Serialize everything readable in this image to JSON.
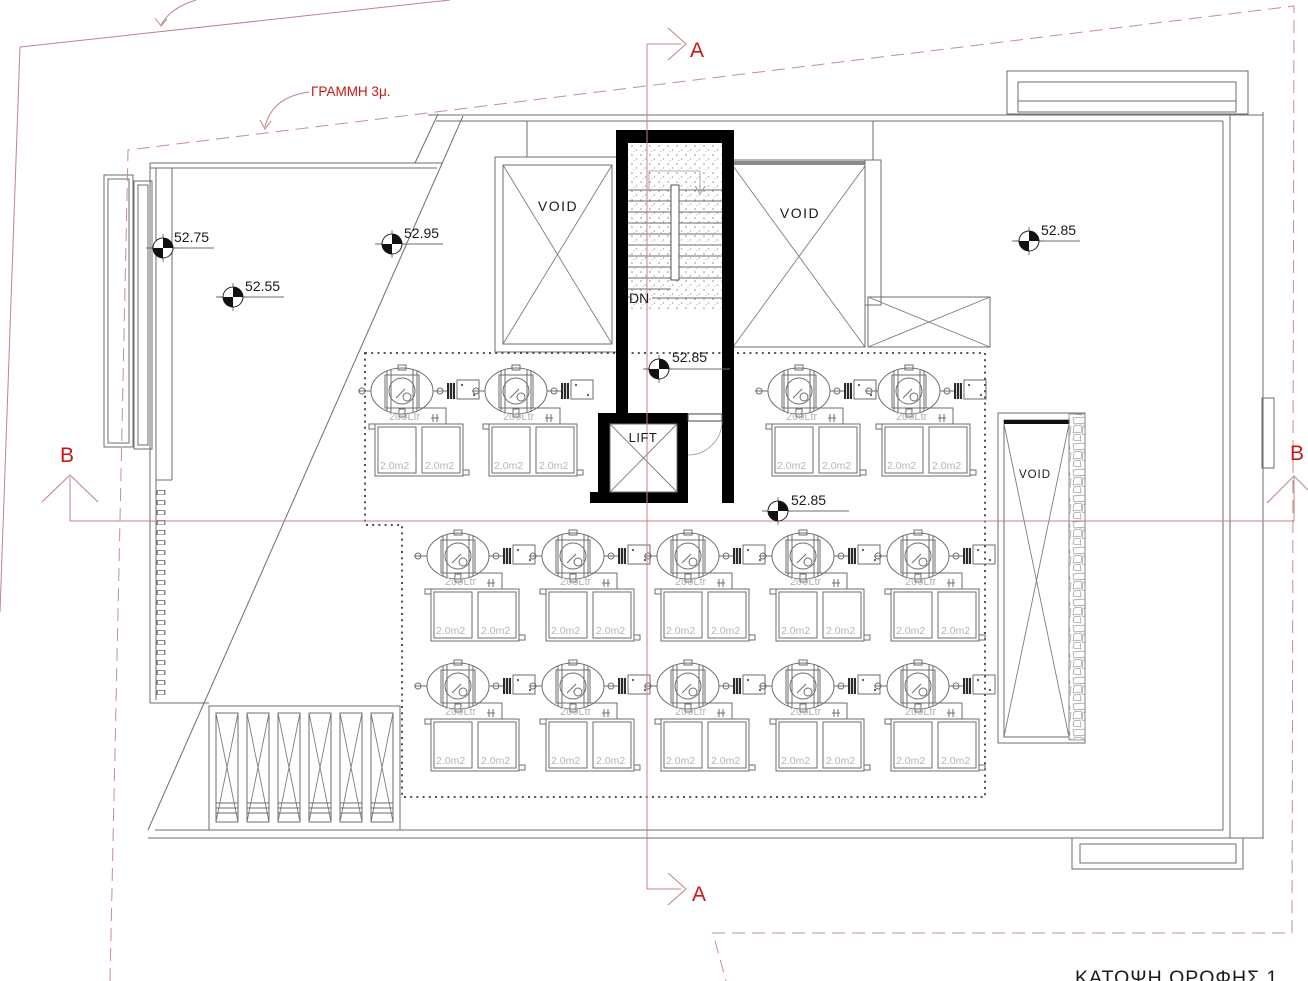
{
  "title": "ΚΑΤΟΨΗ ΟΡΟΦΗΣ 1",
  "annotations": {
    "setback_label": "ΓΡΑΜΜΗ 3μ.",
    "section_a": "A",
    "section_b": "B"
  },
  "labels": {
    "void_label": "VOID",
    "lift_label": "LIFT",
    "down_label": "DN"
  },
  "solar_unit": {
    "tank_label": "200Ltr",
    "panel_label": "2.0m2"
  },
  "elevations": [
    {
      "value": "52.75"
    },
    {
      "value": "52.55"
    },
    {
      "value": "52.95"
    },
    {
      "value": "52.85"
    },
    {
      "value": "52.85"
    },
    {
      "value": "52.85"
    }
  ],
  "colors": {
    "marker_red": "#cc1616",
    "section_line_red": "#c08484",
    "drawing_ink": "#6e6e6e",
    "light_label": "#b5b5b5"
  }
}
